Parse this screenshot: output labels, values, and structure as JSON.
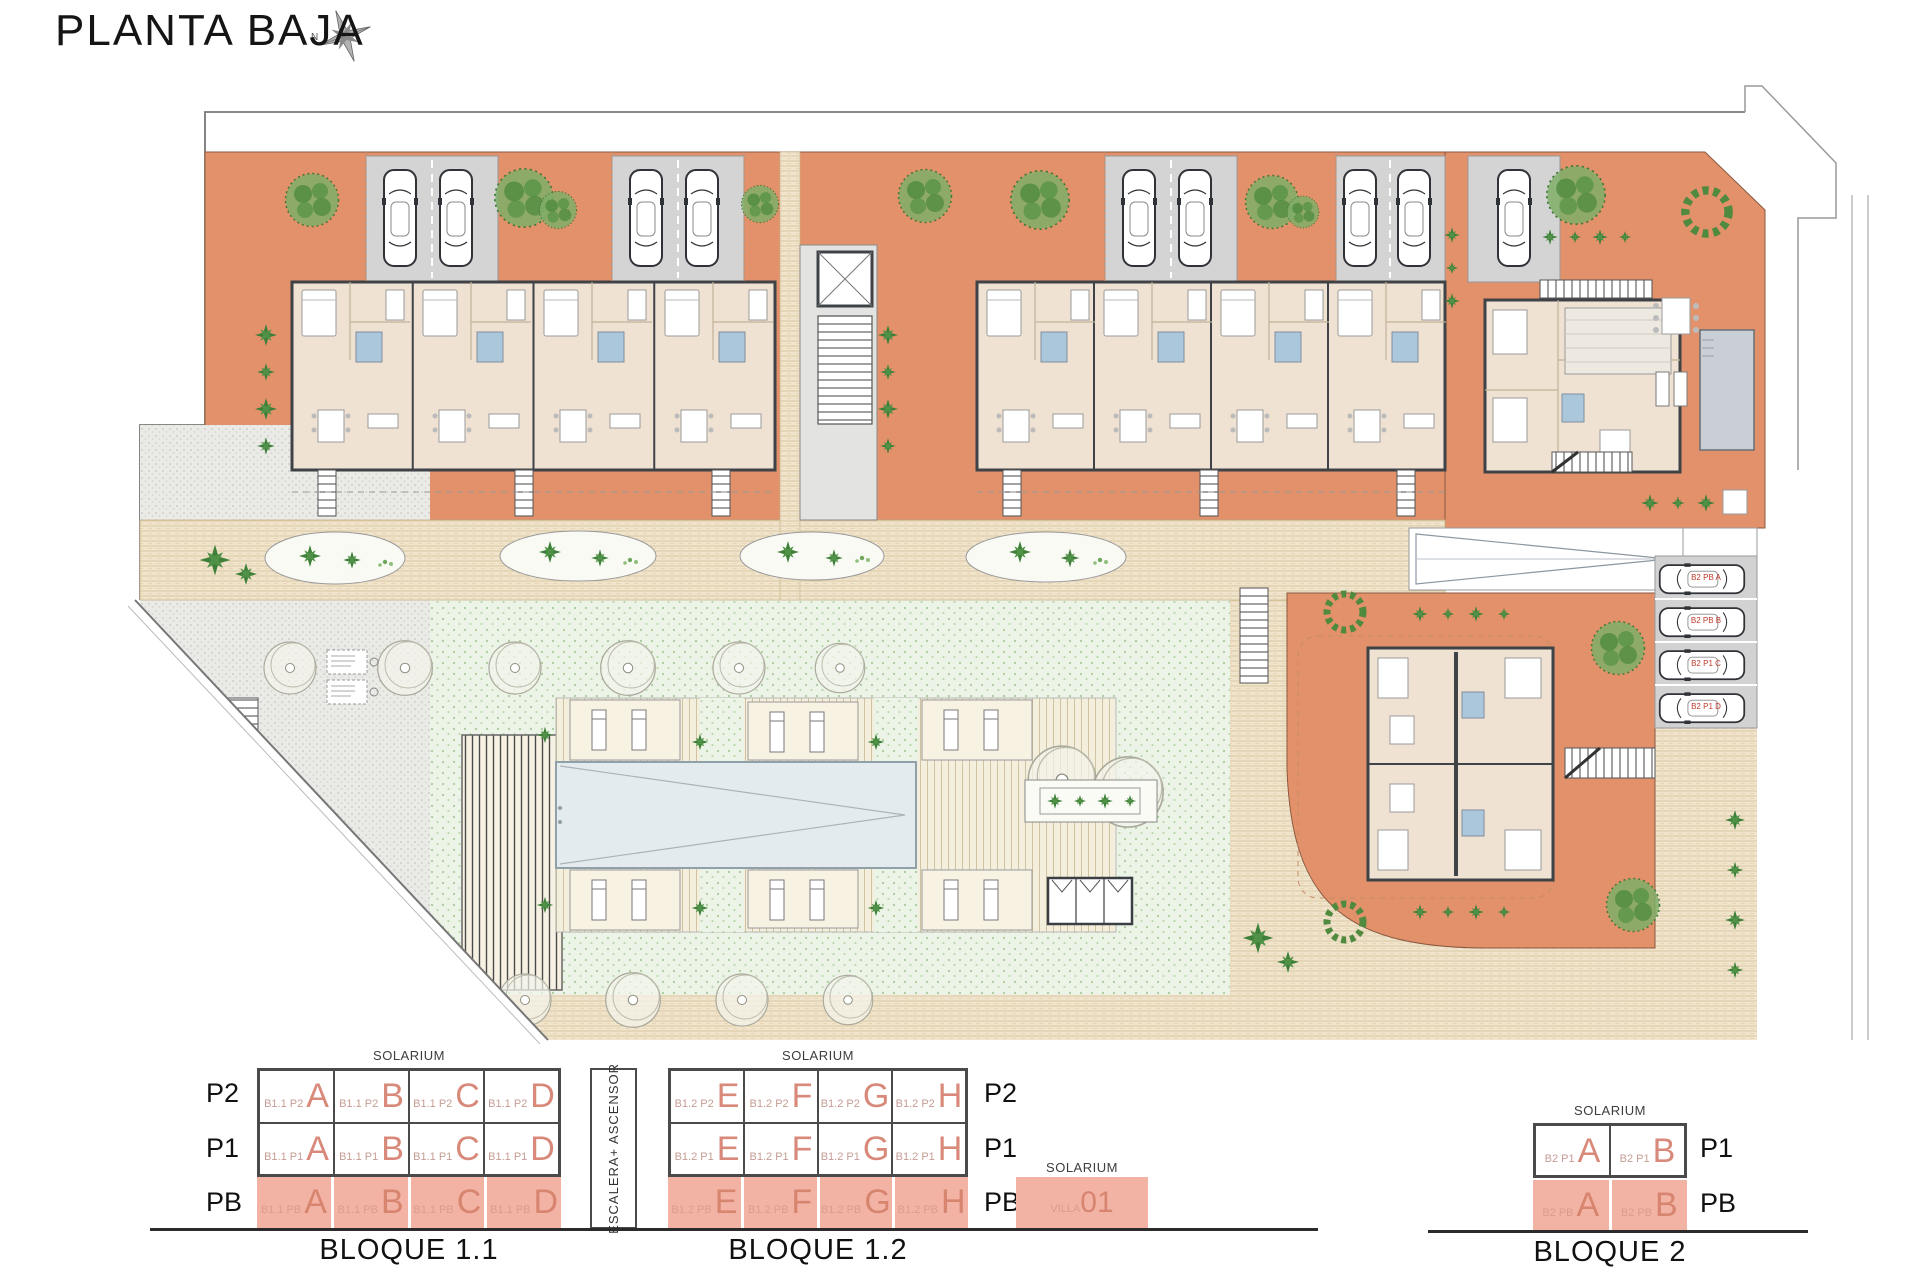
{
  "header": {
    "title": "PLANTA BAJA",
    "compass_north": "N"
  },
  "site_plan": {
    "parking_space_labels": [
      "B2 PB A",
      "B2 PB B",
      "B2 P1 C",
      "B2 P1 D"
    ]
  },
  "legend": {
    "floor_axis": {
      "p2": "P2",
      "p1": "P1",
      "pb": "PB"
    },
    "stairs_label": "ESCALERA+ ASCENSOR",
    "bloque11": {
      "name": "BLOQUE 1.1",
      "solarium": "SOLARIUM",
      "rows": [
        {
          "floor": "P2",
          "cells": [
            {
              "prefix": "B1.1 P2",
              "letter": "A"
            },
            {
              "prefix": "B1.1 P2",
              "letter": "B"
            },
            {
              "prefix": "B1.1 P2",
              "letter": "C"
            },
            {
              "prefix": "B1.1 P2",
              "letter": "D"
            }
          ]
        },
        {
          "floor": "P1",
          "cells": [
            {
              "prefix": "B1.1 P1",
              "letter": "A"
            },
            {
              "prefix": "B1.1 P1",
              "letter": "B"
            },
            {
              "prefix": "B1.1 P1",
              "letter": "C"
            },
            {
              "prefix": "B1.1 P1",
              "letter": "D"
            }
          ]
        },
        {
          "floor": "PB",
          "cells": [
            {
              "prefix": "B1.1 PB",
              "letter": "A"
            },
            {
              "prefix": "B1.1 PB",
              "letter": "B"
            },
            {
              "prefix": "B1.1 PB",
              "letter": "C"
            },
            {
              "prefix": "B1.1 PB",
              "letter": "D"
            }
          ]
        }
      ]
    },
    "bloque12": {
      "name": "BLOQUE 1.2",
      "solarium": "SOLARIUM",
      "rows": [
        {
          "floor": "P2",
          "cells": [
            {
              "prefix": "B1.2 P2",
              "letter": "E"
            },
            {
              "prefix": "B1.2 P2",
              "letter": "F"
            },
            {
              "prefix": "B1.2 P2",
              "letter": "G"
            },
            {
              "prefix": "B1.2 P2",
              "letter": "H"
            }
          ]
        },
        {
          "floor": "P1",
          "cells": [
            {
              "prefix": "B1.2 P1",
              "letter": "E"
            },
            {
              "prefix": "B1.2 P1",
              "letter": "F"
            },
            {
              "prefix": "B1.2 P1",
              "letter": "G"
            },
            {
              "prefix": "B1.2 P1",
              "letter": "H"
            }
          ]
        },
        {
          "floor": "PB",
          "cells": [
            {
              "prefix": "B1.2 PB",
              "letter": "E"
            },
            {
              "prefix": "B1.2 PB",
              "letter": "F"
            },
            {
              "prefix": "B1.2 PB",
              "letter": "G"
            },
            {
              "prefix": "B1.2 PB",
              "letter": "H"
            }
          ]
        }
      ]
    },
    "villa": {
      "solarium": "SOLARIUM",
      "label": "VILLA",
      "number": "01"
    },
    "bloque2": {
      "name": "BLOQUE 2",
      "solarium": "SOLARIUM",
      "rows": [
        {
          "floor": "P1",
          "cells": [
            {
              "prefix": "B2 P1",
              "letter": "A"
            },
            {
              "prefix": "B2 P1",
              "letter": "B"
            }
          ]
        },
        {
          "floor": "PB",
          "cells": [
            {
              "prefix": "B2 PB",
              "letter": "A"
            },
            {
              "prefix": "B2 PB",
              "letter": "B"
            }
          ]
        }
      ]
    }
  }
}
